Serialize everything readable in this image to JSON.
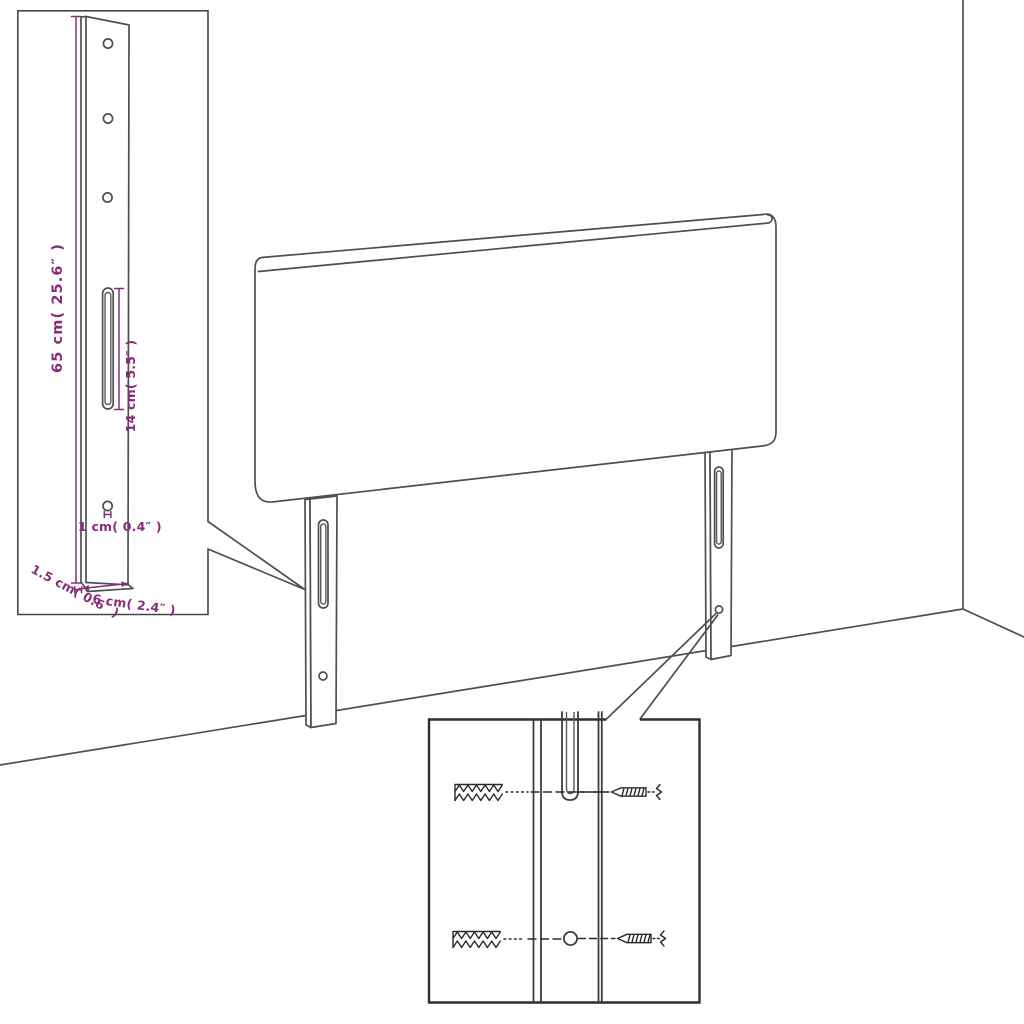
{
  "page": {
    "title": "Headboard assembly dimension diagram",
    "background": "#ffffff"
  },
  "colors": {
    "drawing_line": "#4f4f4f",
    "dimension_accent": "#862d7b",
    "detail_inset_border": "#474747",
    "hardware_inset_border": "#2e2e2e"
  },
  "detail_inset": {
    "height_label": "65 cm( 25.6″ )",
    "slot_label": "14 cm( 5.5″ )",
    "hole_label": "1 cm( 0.4″ )",
    "depth_label": "1.5 cm( 0.6″ )",
    "width_label": "6 cm( 2.4″ )"
  },
  "hardware_inset": {
    "icons": [
      "wall-plug-icon",
      "screw-icon",
      "leg-slot",
      "leg-hole"
    ]
  }
}
